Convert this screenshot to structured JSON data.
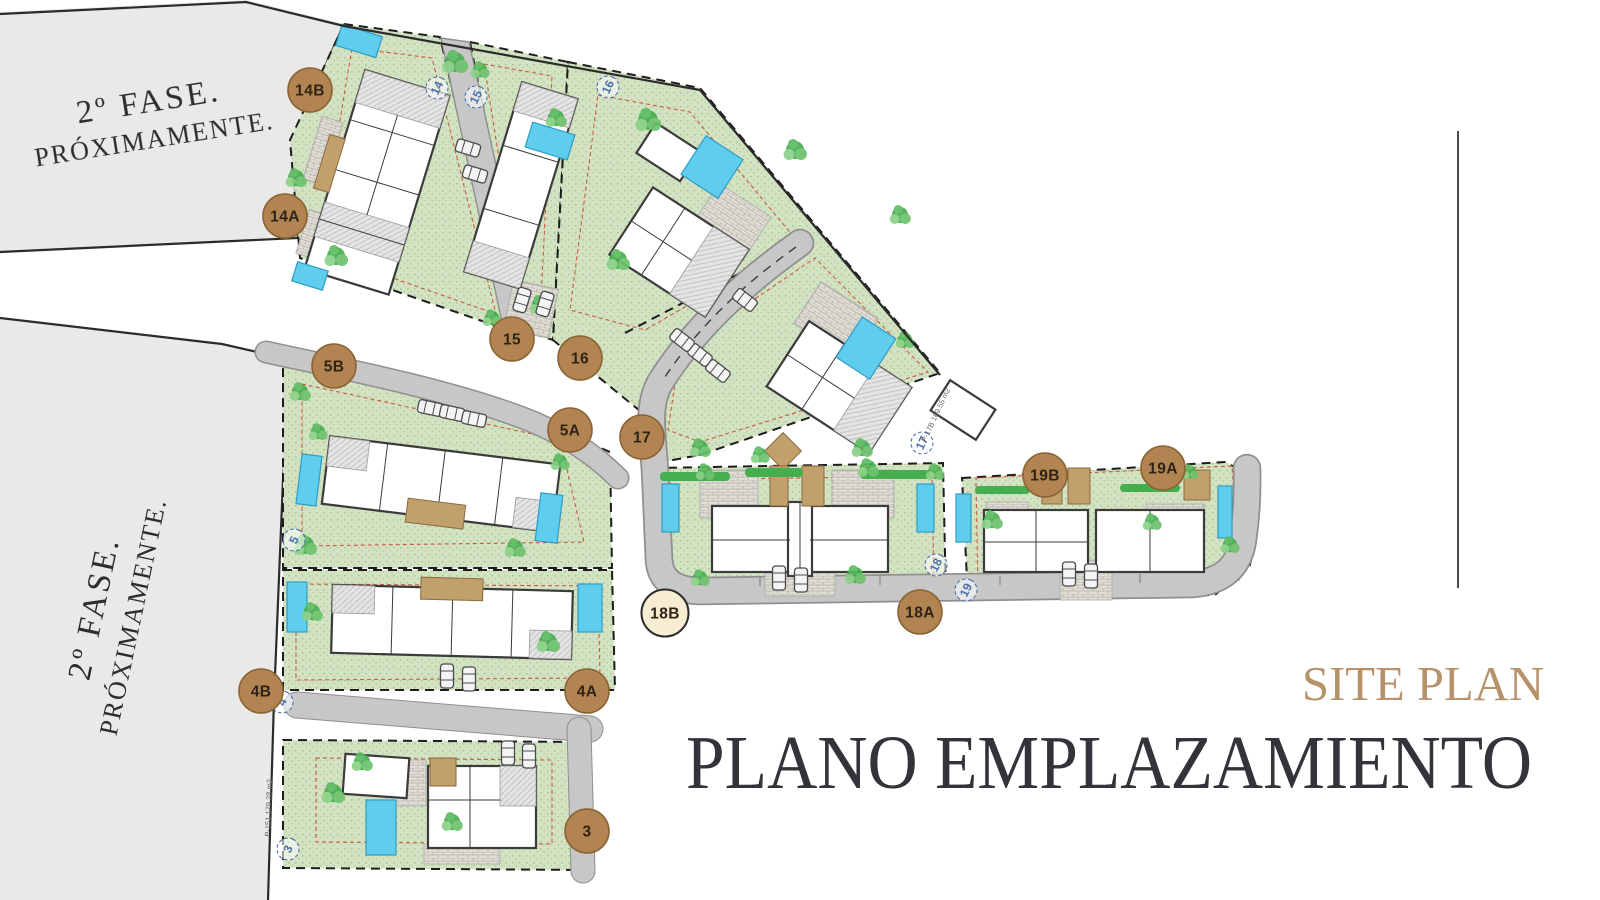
{
  "phase_note": {
    "line1": "2º FASE.",
    "line2": "PRÓXIMAMENTE."
  },
  "titles": {
    "subtitle": "SITE PLAN",
    "title": "PLANO EMPLAZAMIENTO"
  },
  "markers": [
    {
      "label": "14B"
    },
    {
      "label": "14A"
    },
    {
      "label": "15"
    },
    {
      "label": "16"
    },
    {
      "label": "17"
    },
    {
      "label": "5B"
    },
    {
      "label": "5A"
    },
    {
      "label": "4B"
    },
    {
      "label": "4A"
    },
    {
      "label": "3"
    },
    {
      "label": "18B"
    },
    {
      "label": "18A"
    },
    {
      "label": "19B"
    },
    {
      "label": "19A"
    }
  ],
  "plot_badges": {
    "p14": "14",
    "p15": "15",
    "p16": "16",
    "p17": "17",
    "p18": "18",
    "p19": "19",
    "p5": "5",
    "p4": "4",
    "p3": "3"
  },
  "annotations": {
    "plot3": "P-151 179.28 m2",
    "plot17": "P-17B 169.55 m2"
  },
  "colors": {
    "marker_brown": "#b28451",
    "marker_cream": "#f7edd2",
    "grass": "#d3e2c2",
    "road": "#c7c7c7",
    "pool_blue": "#5ecdee",
    "accent_gold": "#b6926a",
    "title_dark": "#33343a",
    "phase_gray": "#e9e9e8"
  }
}
